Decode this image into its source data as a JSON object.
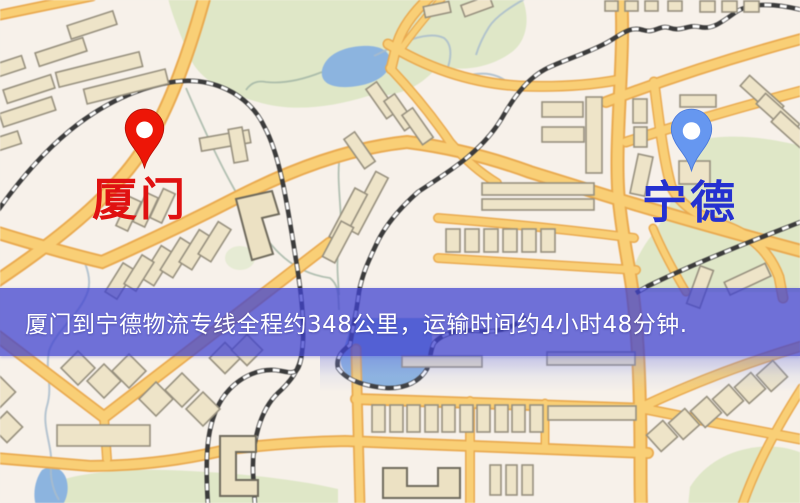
{
  "banner": {
    "text": "厦门到宁德物流专线全程约348公里，运输时间约4小时48分钟.",
    "background_color": "#4242d0",
    "text_color": "#ffffff"
  },
  "route_info": {
    "origin": "厦门",
    "destination": "宁德",
    "distance_text": "约348公里",
    "duration_text": "约4小时48分钟"
  },
  "map": {
    "origin_marker": {
      "label": "厦门",
      "pin_color": "#ed1607",
      "label_color": "#e01111"
    },
    "destination_marker": {
      "label": "宁德",
      "pin_color": "#6697f0",
      "label_color": "#2531d0"
    },
    "palette": {
      "background": "#f7f1ea",
      "road_fill": "#f8cf78",
      "road_casing": "#e8aa52",
      "building": "#eee4c9",
      "park": "#dfe7c8",
      "water": "#8db4de",
      "railway": "#3b3b3b"
    }
  }
}
